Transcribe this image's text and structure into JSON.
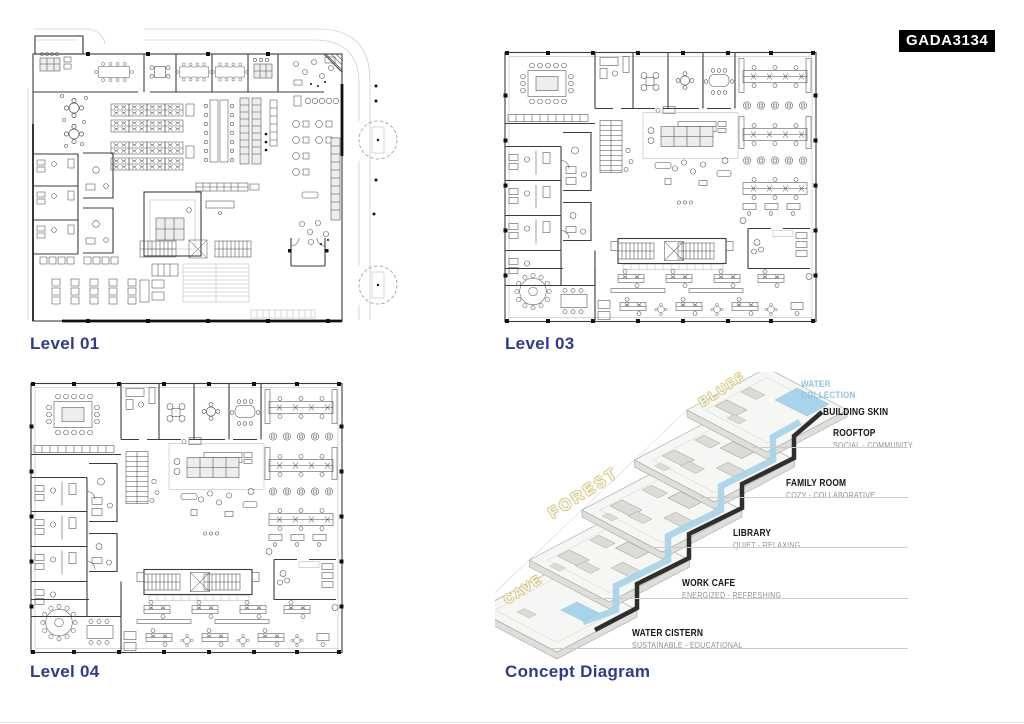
{
  "board": {
    "code": "GADA3134",
    "accent_color": "#2f3b8f",
    "water_color": "#a7d4ea",
    "zone_outline_color": "#d2c478"
  },
  "plans": [
    {
      "label": "Level 01"
    },
    {
      "label": "Level 03"
    },
    {
      "label": "Level 04"
    }
  ],
  "concept": {
    "label": "Concept Diagram",
    "water_collection": "WATER COLLECTION",
    "zones": [
      {
        "label": "BLUFF"
      },
      {
        "label": "FOREST"
      },
      {
        "label": "CAVE"
      }
    ],
    "annotations": [
      {
        "name": "BUILDING SKIN",
        "desc": ""
      },
      {
        "name": "ROOFTOP",
        "desc": "SOCIAL - COMMUNITY"
      },
      {
        "name": "FAMILY ROOM",
        "desc": "COZY - COLLABORATIVE"
      },
      {
        "name": "LIBRARY",
        "desc": "QUIET - RELAXING"
      },
      {
        "name": "WORK CAFE",
        "desc": "ENERGIZED - REFRESHING"
      },
      {
        "name": "WATER CISTERN",
        "desc": "SUSTAINABLE - EDUCATIONAL"
      }
    ]
  }
}
